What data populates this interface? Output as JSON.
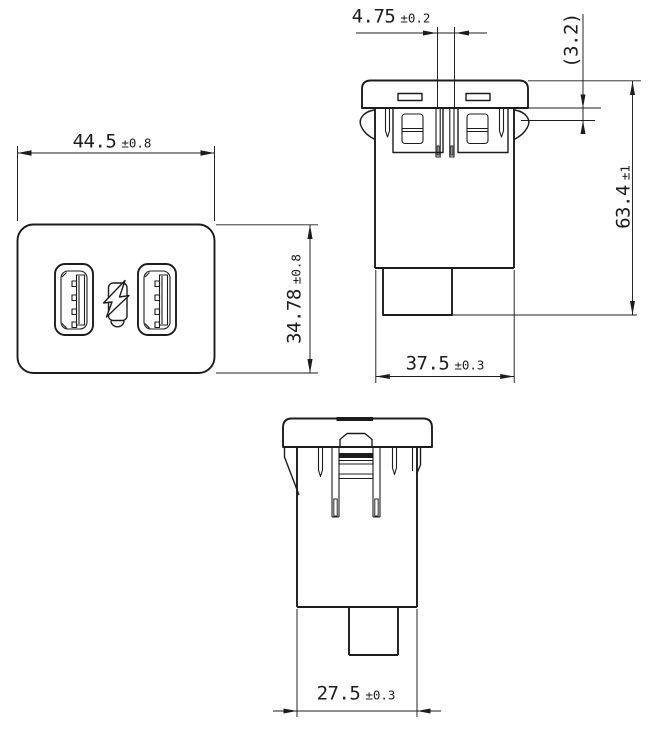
{
  "drawing": {
    "colors": {
      "line": "#1c1c1c",
      "background": "#ffffff"
    },
    "icons": {
      "fast_charge_icon": "lightning-bolt"
    },
    "dimensions": {
      "front_width": {
        "value": "44.5",
        "tolerance": "±0.8"
      },
      "front_height": {
        "value": "34.78",
        "tolerance": "±0.8"
      },
      "pin_pitch": {
        "value": "4.75",
        "tolerance": "±0.2"
      },
      "flange_thickness": {
        "value": "(3.2)",
        "tolerance": ""
      },
      "overall_depth": {
        "value": "63.4",
        "tolerance": "±1"
      },
      "side_body_width": {
        "value": "37.5",
        "tolerance": "±0.3"
      },
      "bottom_body_width": {
        "value": "27.5",
        "tolerance": "±0.3"
      }
    }
  }
}
